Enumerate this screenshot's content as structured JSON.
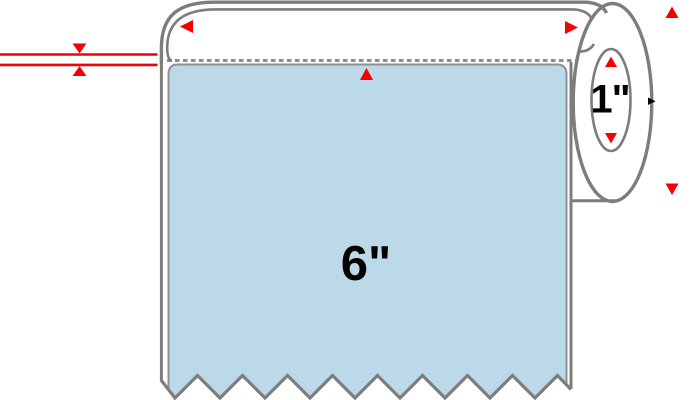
{
  "diagram": {
    "type": "label-roll-dimension-diagram",
    "label_length_text": "6\"",
    "core_diameter_text": "1\"",
    "colors": {
      "background": "#ffffff",
      "outline-gray": "#7d7d7d",
      "dash-gray": "#8c8c8c",
      "label-stroke-gray": "#909090",
      "label-blue": "#bcd9ea",
      "liner-white": "#ffffff",
      "dimension-red": "#f50000",
      "text-black": "#000000"
    },
    "annotations": {
      "roll_width_arrows": [
        "left",
        "right"
      ],
      "outer_diameter_arrows": [
        "up",
        "down"
      ],
      "core_diameter_arrows": [
        "up",
        "down"
      ],
      "label_top_arrow": "up",
      "liner_thickness_marker": "double-red-line-with-opposed-arrows"
    }
  }
}
